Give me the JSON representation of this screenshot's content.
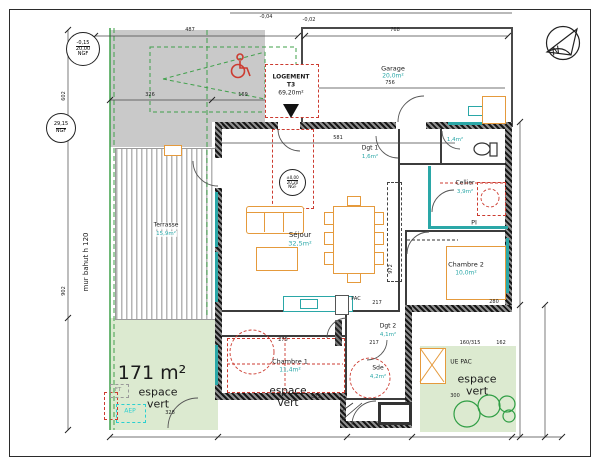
{
  "colors": {
    "wall_hatch": "#161616",
    "teal_fixture": "#2aa7a7",
    "furniture_orange": "#e59a3c",
    "red_dashed": "#cc3b30",
    "boundary_green": "#3fa04a",
    "green_fill": "#dcead0",
    "parking_gray": "#c9c9c9"
  },
  "compass": {
    "n": "N"
  },
  "title_box": {
    "l1": "LOGEMENT",
    "l2": "T3",
    "area": "69,20m²"
  },
  "levels": {
    "ngf1": {
      "l1": "-0,15",
      "l2": "20,00",
      "l3": "NGF"
    },
    "ngf2": {
      "l1": "29,15",
      "l2": "NGF"
    },
    "ngf3": {
      "l1": "±0,00",
      "l2": "20,20",
      "l3": "NGF"
    }
  },
  "rooms": {
    "garage": {
      "name": "Garage",
      "area": "20,0m²"
    },
    "sejour": {
      "name": "Séjour",
      "area": "32,5m²"
    },
    "dgt1": {
      "name": "Dgt 1",
      "area": "1,6m²"
    },
    "wc": {
      "area": "1,4m²"
    },
    "cellier": {
      "name": "Cellier",
      "area": "3,9m²"
    },
    "chambre2": {
      "name": "Chambre 2",
      "area": "10,0m²"
    },
    "chambre1": {
      "name": "Chambre 1",
      "area": "11,4m²"
    },
    "sde": {
      "name": "Sde",
      "area": "4,2m²"
    },
    "dgt2": {
      "name": "Dgt 2",
      "area": "4,1m²"
    },
    "terrasse": {
      "name": "Terrasse",
      "area": "15,9m²"
    }
  },
  "green": {
    "left": {
      "size": "171 m²",
      "l1": "espace",
      "l2": "vert",
      "dim": "328"
    },
    "center": {
      "l1": "espace",
      "l2": "vert",
      "dim": "873"
    },
    "right": {
      "l1": "espace",
      "l2": "vert",
      "dim": "300"
    }
  },
  "equipment": {
    "ue_pac": "UE PAC",
    "pac": "PAC",
    "pi": "PI",
    "aep": "AEP",
    "ft": "FT"
  },
  "notes": {
    "mur_bahut": "mur bahut h 120"
  },
  "dims": {
    "d487": "487",
    "d768": "768",
    "lvl1": "-0,04",
    "lvl2": "-0,02",
    "d326": "326",
    "d169": "169",
    "d756": "756",
    "d581": "581",
    "d602": "602",
    "d902": "902",
    "d972": "972",
    "d280": "280",
    "d217a": "217",
    "d217b": "217",
    "d275": "275",
    "d160_315": "160/315",
    "d162": "162"
  }
}
